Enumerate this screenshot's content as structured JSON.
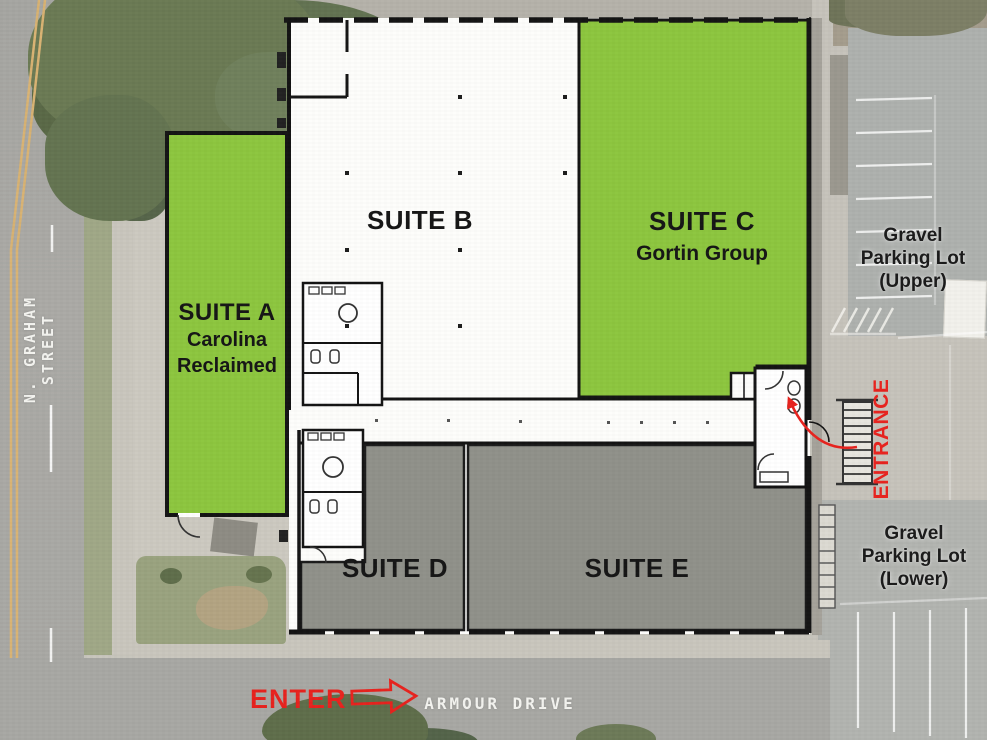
{
  "colors": {
    "suite_green": "#8dc63f",
    "suite_gray": "#90918a",
    "suite_white": "#fdfdfb",
    "wall_black": "#161616",
    "accent_red": "#e8231e",
    "street_text_white": "#f4f4f0"
  },
  "streets": {
    "graham": "N. GRAHAM STREET",
    "armour": "ARMOUR DRIVE"
  },
  "suites": {
    "a": {
      "label": "SUITE A",
      "tenant1": "Carolina",
      "tenant2": "Reclaimed"
    },
    "b": {
      "label": "SUITE B"
    },
    "c": {
      "label": "SUITE C",
      "tenant1": "Gortin Group"
    },
    "d": {
      "label": "SUITE D"
    },
    "e": {
      "label": "SUITE E"
    }
  },
  "parking": {
    "upper": {
      "line1": "Gravel",
      "line2": "Parking Lot",
      "line3": "(Upper)"
    },
    "lower": {
      "line1": "Gravel",
      "line2": "Parking Lot",
      "line3": "(Lower)"
    }
  },
  "annotations": {
    "entrance": "ENTRANCE",
    "enter": "ENTER"
  }
}
